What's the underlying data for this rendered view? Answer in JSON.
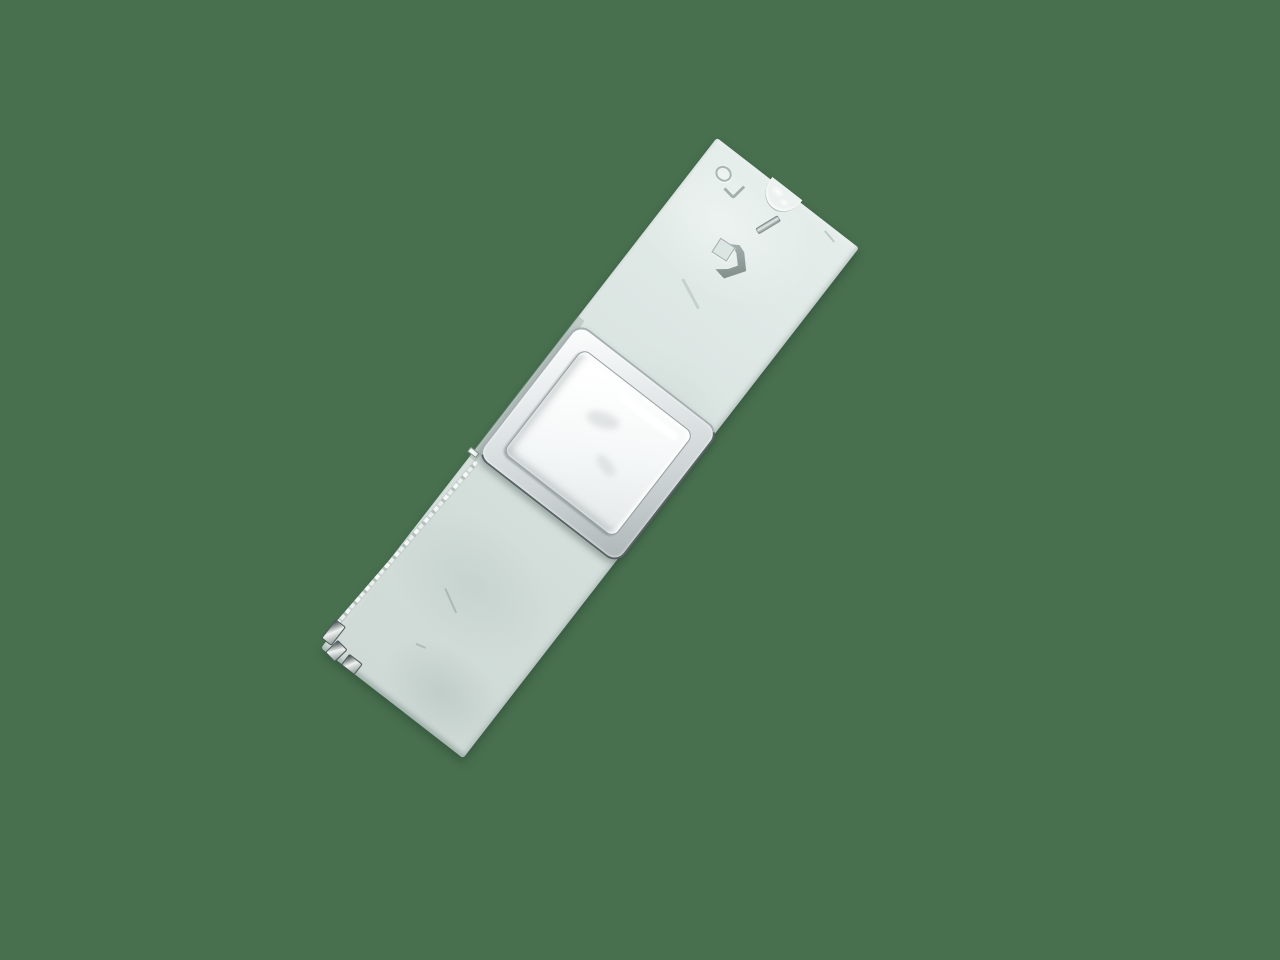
{
  "scene": {
    "description": "Product photograph of a white ceramic substrate strip with a square metallic can component, shown diagonally on a plain green background",
    "rotation_deg": 37.8
  },
  "colors": {
    "background": "#48704F",
    "board_light": "#E4EDEA",
    "board_mid": "#DAE4E1",
    "board_dark": "#D2DDD9",
    "board_edge_shadow": "#9FB2AB",
    "can_rim_light": "#FDFEFE",
    "can_rim_dark": "#AEB6B7",
    "can_outline": "#5A6365",
    "can_top_light": "#FFFFFF",
    "can_top_dark": "#E7EBEB",
    "marking_gray": "#7E8B89",
    "solder_bright": "#F4F8F6",
    "solder_dark": "#4E5758"
  },
  "objects": {
    "board": {
      "name": "white-substrate-strip"
    },
    "component": {
      "name": "metal-can-shield"
    },
    "markings": [
      {
        "name": "ring-mark"
      },
      {
        "name": "chevron-mark"
      },
      {
        "name": "bar-mark"
      },
      {
        "name": "cube-arrow-logo"
      },
      {
        "name": "edge-castellation"
      }
    ],
    "solder": {
      "trace": {
        "name": "edge-solder-trace"
      },
      "pads": {
        "count": 3
      },
      "stub": {
        "name": "corner-pin-stub"
      }
    }
  }
}
